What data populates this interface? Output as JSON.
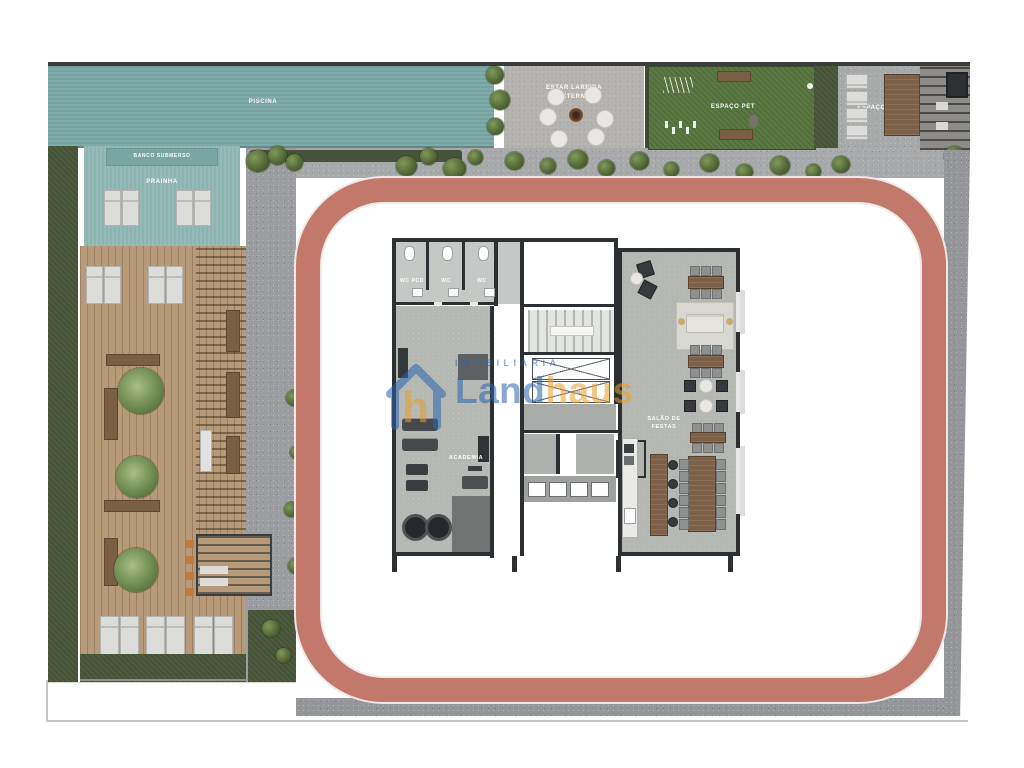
{
  "plan_title": "Implantação / pavimento de lazer",
  "colors": {
    "pool": "#79a7a4",
    "prainha": "#8fb7b3",
    "grass": "#4e5c3e",
    "pet_lawn": "#5c7a44",
    "deck_wood": "#b79a79",
    "track_pink": "#c2796c",
    "pavement": "#9b9da1",
    "wall": "#2c3033",
    "watermark_blue": "#2a63ad",
    "watermark_orange": "#e8a02c"
  },
  "areas": {
    "piscina": {
      "label": "PISCINA"
    },
    "banco_submerso": {
      "label": "BANCO SUBMERSO"
    },
    "prainha": {
      "label": "PRAINHA"
    },
    "estar_lareira": {
      "line1": "ESTAR LAREIRA",
      "line2": "EXTERNA"
    },
    "espaco_pet": {
      "label": "ESPAÇO PET"
    },
    "espaco_parrilla": {
      "label": "ESPAÇO PARRILLA"
    },
    "wc_pcd": {
      "label": "WC PCD"
    },
    "wc_1": {
      "label": "WC"
    },
    "wc_2": {
      "label": "WC"
    },
    "academia": {
      "label": "ACADEMIA"
    },
    "salao_festas": {
      "line1": "SALÃO DE",
      "line2": "FESTAS"
    }
  },
  "watermark": {
    "tagline": "IMOBILIÁRIA",
    "brand_part1": "Land",
    "brand_part2": "haus",
    "icon_letter": "h"
  }
}
